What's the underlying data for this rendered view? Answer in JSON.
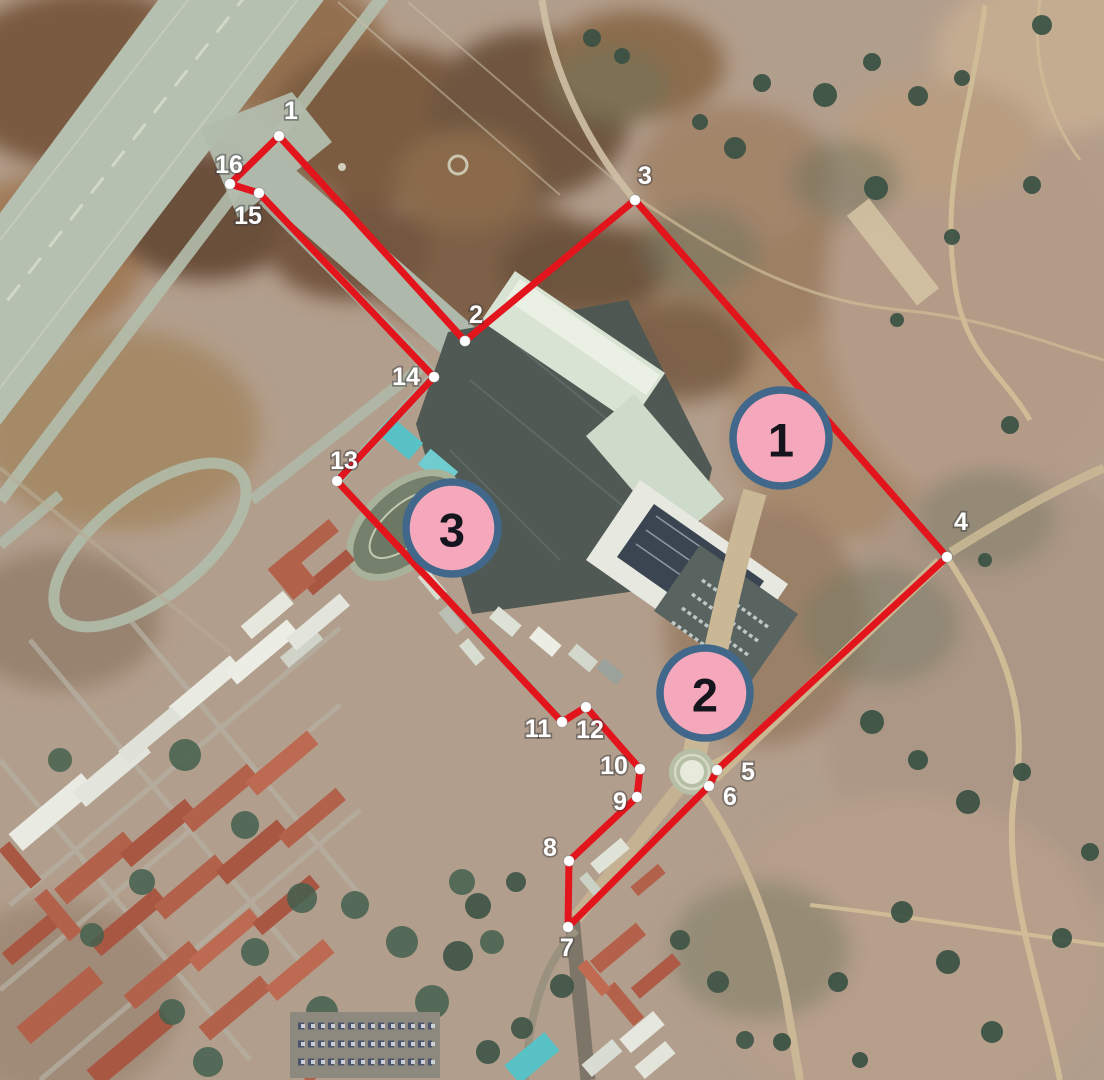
{
  "figure": {
    "description": "Aerial photograph of an airbase and adjacent town with a red surveyed perimeter, 16 numbered boundary points and 3 circled zone markers",
    "width": 1104,
    "height": 1080
  },
  "boundary": {
    "line_color": "#e2141c",
    "line_width": 7,
    "point_dot_color": "#ffffff",
    "point_label_color": "#ffffff",
    "path_order": [
      "1",
      "16",
      "15",
      "14",
      "13",
      "11",
      "12",
      "10",
      "9",
      "8",
      "7",
      "6",
      "5",
      "4",
      "3",
      "2"
    ],
    "points": [
      {
        "label": "1",
        "x": 279,
        "y": 136,
        "lx": 291,
        "ly": 111
      },
      {
        "label": "2",
        "x": 465,
        "y": 341,
        "lx": 476,
        "ly": 315
      },
      {
        "label": "3",
        "x": 635,
        "y": 200,
        "lx": 645,
        "ly": 176
      },
      {
        "label": "4",
        "x": 947,
        "y": 557,
        "lx": 961,
        "ly": 522
      },
      {
        "label": "5",
        "x": 717,
        "y": 770,
        "lx": 748,
        "ly": 772
      },
      {
        "label": "6",
        "x": 709,
        "y": 786,
        "lx": 730,
        "ly": 797
      },
      {
        "label": "7",
        "x": 568,
        "y": 927,
        "lx": 567,
        "ly": 948
      },
      {
        "label": "8",
        "x": 569,
        "y": 861,
        "lx": 550,
        "ly": 848
      },
      {
        "label": "9",
        "x": 637,
        "y": 797,
        "lx": 620,
        "ly": 802
      },
      {
        "label": "10",
        "x": 640,
        "y": 769,
        "lx": 614,
        "ly": 766
      },
      {
        "label": "11",
        "x": 562,
        "y": 722,
        "lx": 538,
        "ly": 729
      },
      {
        "label": "12",
        "x": 586,
        "y": 707,
        "lx": 590,
        "ly": 730
      },
      {
        "label": "13",
        "x": 337,
        "y": 481,
        "lx": 344,
        "ly": 461
      },
      {
        "label": "14",
        "x": 434,
        "y": 377,
        "lx": 406,
        "ly": 377
      },
      {
        "label": "15",
        "x": 259,
        "y": 193,
        "lx": 248,
        "ly": 216
      },
      {
        "label": "16",
        "x": 230,
        "y": 184,
        "lx": 229,
        "ly": 165
      }
    ]
  },
  "zones": {
    "fill": "#f5a7bb",
    "border": "#41688a",
    "text_color": "#15151d",
    "markers": [
      {
        "label": "1",
        "x": 781,
        "y": 438,
        "r": 48
      },
      {
        "label": "2",
        "x": 705,
        "y": 693,
        "r": 45
      },
      {
        "label": "3",
        "x": 452,
        "y": 528,
        "r": 46
      }
    ]
  }
}
